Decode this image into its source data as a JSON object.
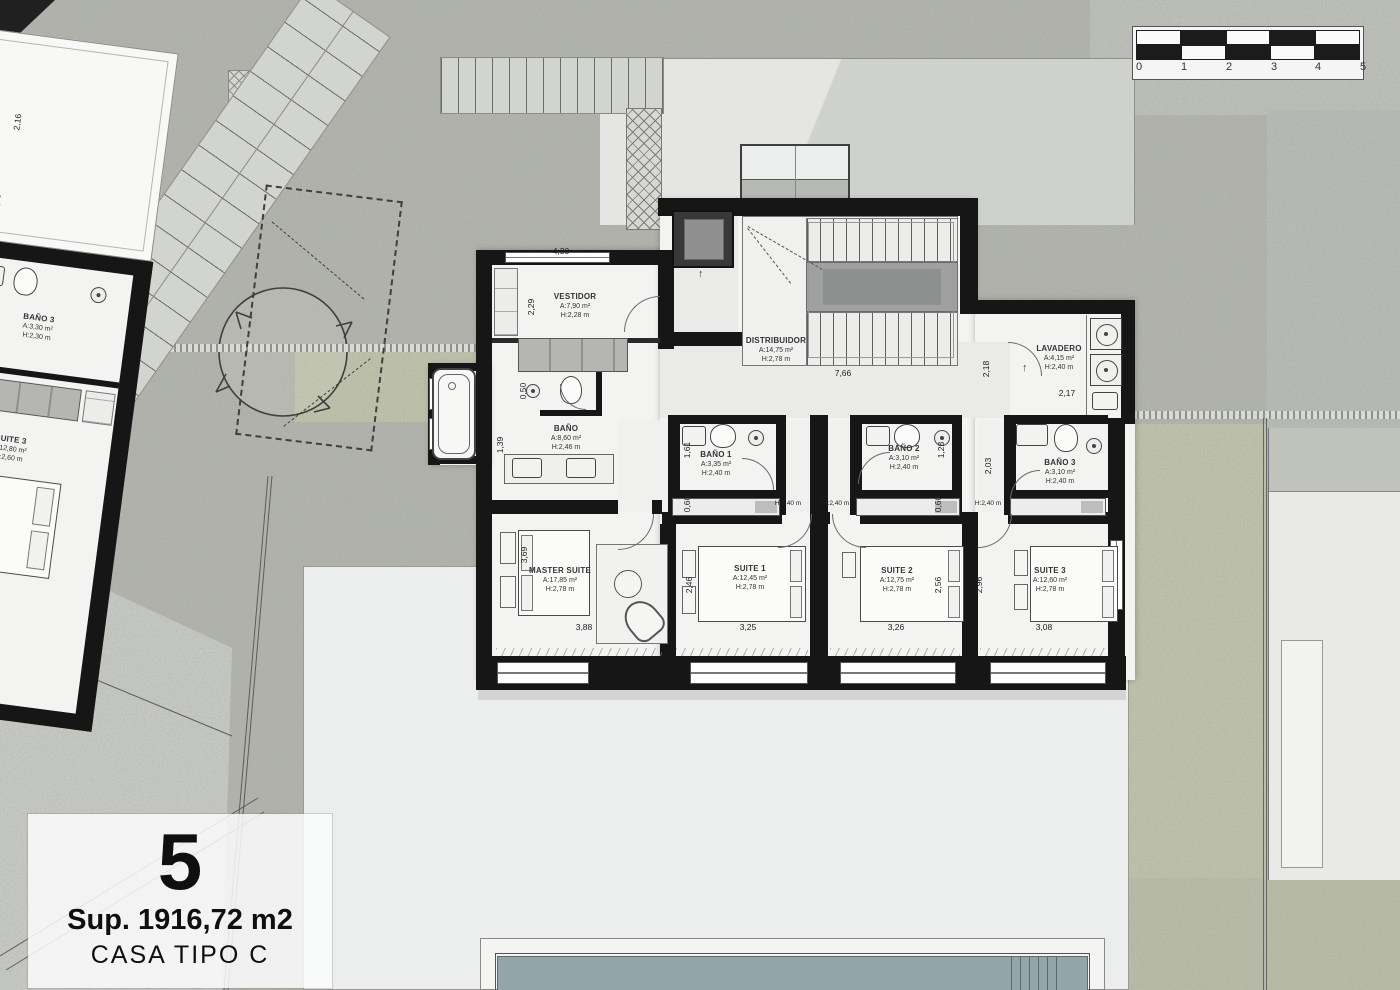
{
  "title_block": {
    "number": "5",
    "surface": "Sup. 1916,72 m2",
    "type_label": "CASA TIPO C"
  },
  "scale_bar": {
    "ticks": [
      "0",
      "1",
      "2",
      "3",
      "4",
      "5"
    ]
  },
  "rooms": {
    "vestidor": {
      "name": "VESTIDOR",
      "area": "A:7,90 m²",
      "height": "H:2,28 m"
    },
    "distribuidor": {
      "name": "DISTRIBUIDOR",
      "area": "A:14,75 m²",
      "height": "H:2,78 m"
    },
    "lavadero": {
      "name": "LAVADERO",
      "area": "A:4,15 m²",
      "height": "H:2,40 m"
    },
    "bano": {
      "name": "BAÑO",
      "area": "A:8,60 m²",
      "height": "H:2,46 m"
    },
    "bano1": {
      "name": "BAÑO 1",
      "area": "A:3,35 m²",
      "height": "H:2,40 m"
    },
    "bano2": {
      "name": "BAÑO 2",
      "area": "A:3,10 m²",
      "height": "H:2,40 m"
    },
    "bano3": {
      "name": "BAÑO 3",
      "area": "A:3,10 m²",
      "height": "H:2,40 m"
    },
    "master_suite": {
      "name": "MASTER SUITE",
      "area": "A:17,85 m²",
      "height": "H:2,78 m"
    },
    "suite1": {
      "name": "SUITE 1",
      "area": "A:12,45 m²",
      "height": "H:2,78 m"
    },
    "suite2": {
      "name": "SUITE 2",
      "area": "A:12,75 m²",
      "height": "H:2,78 m"
    },
    "suite3": {
      "name": "SUITE 3",
      "area": "A:12,60 m²",
      "height": "H:2,78 m"
    },
    "bano3_west": {
      "name": "BAÑO 3",
      "area": "A:3,30 m²",
      "height": "H:2,30 m"
    },
    "suite3_west": {
      "name": "SUITE 3",
      "area": "A:12,80 m²",
      "height": "H:2,60 m"
    }
  },
  "dims": {
    "vestidor_top": "4,30",
    "vestidor_left": "2,29",
    "wc_niche": "0,50",
    "bano_left": "1,39",
    "hall_width": "7,66",
    "hall_right": "2,18",
    "lavadero_width": "2,17",
    "corridor_right": "2,03",
    "bano1_left": "1,61",
    "bano2_right": "1,28",
    "bench1": "0,60",
    "bench2": "0,60",
    "corr_h1": "H:2,40 m",
    "corr_h2": "H:2,40 m",
    "corr_h3": "H:2,40 m",
    "master_left": "3,69",
    "master_width": "3,88",
    "suite1_left": "2,46",
    "suite1_width": "3,25",
    "suite2_side": "2,56",
    "suite2_width": "3,26",
    "suite23_side": "2,96",
    "suite3_width": "3,08",
    "west_suite_height": "5,00",
    "west_suite_width": "3,20",
    "west_roof_a": "2,16",
    "west_roof_b": "1,30"
  },
  "colors": {
    "wall": "#161616",
    "grass": "#c3c7ad",
    "water": "#93a5a9",
    "ground": "#b4b7af"
  }
}
